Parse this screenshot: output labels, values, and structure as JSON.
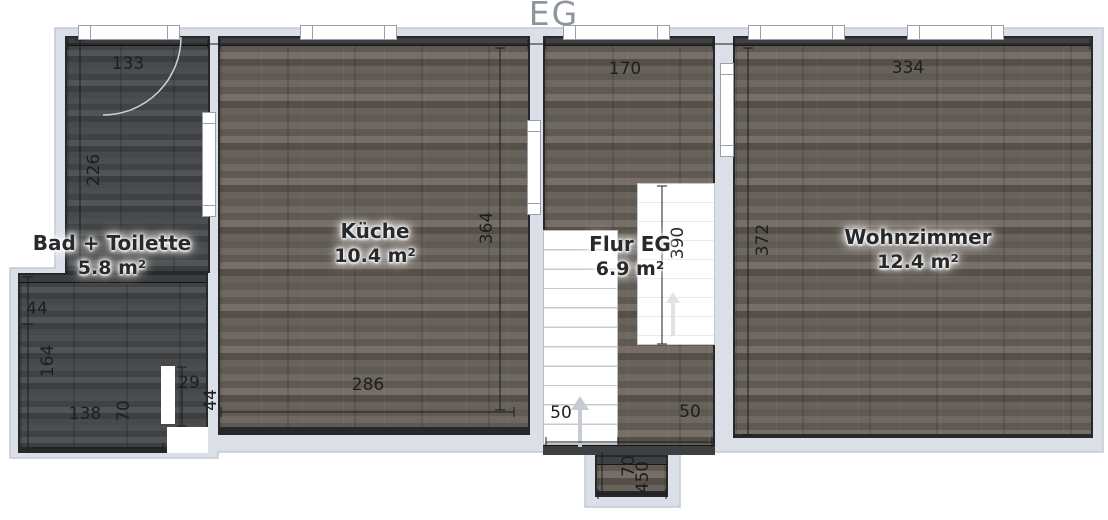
{
  "title": "EG",
  "rooms": [
    {
      "id": "bad",
      "name": "Bad + Toilette",
      "area": "5.8 m²"
    },
    {
      "id": "kueche",
      "name": "Küche",
      "area": "10.4 m²"
    },
    {
      "id": "flur",
      "name": "Flur EG",
      "area": "6.9 m²"
    },
    {
      "id": "wohnzimmer",
      "name": "Wohnzimmer",
      "area": "12.4 m²"
    }
  ],
  "dimensions": {
    "bad_top_width": "133",
    "bad_left_height": "226",
    "ext_top_height": "44",
    "ext_left_height": "164",
    "ext_bottom_width": "138",
    "ext_notch_height": "70",
    "notch_width": "29",
    "notch_wall": "44",
    "kueche_bottom_width": "286",
    "kueche_right_height": "364",
    "flur_top_width": "170",
    "stair_void_height": "390",
    "stairs_width": "50",
    "flur_bottom_right": "50",
    "entry_width": "70",
    "entry_depth": "450",
    "wohnzimmer_top_width": "334",
    "wohnzimmer_left_height": "372"
  },
  "colors": {
    "outline": "#dbdfe7",
    "outline_stroke": "#c3c9d3",
    "wood_floor": "#69635d",
    "dark_floor": "#46484a",
    "wall": "#3e4042",
    "dimension_text": "#1c1e20",
    "room_label_text": "#28292b",
    "title_text": "#8f959e",
    "stair_arrow": "#c7ccd3"
  }
}
